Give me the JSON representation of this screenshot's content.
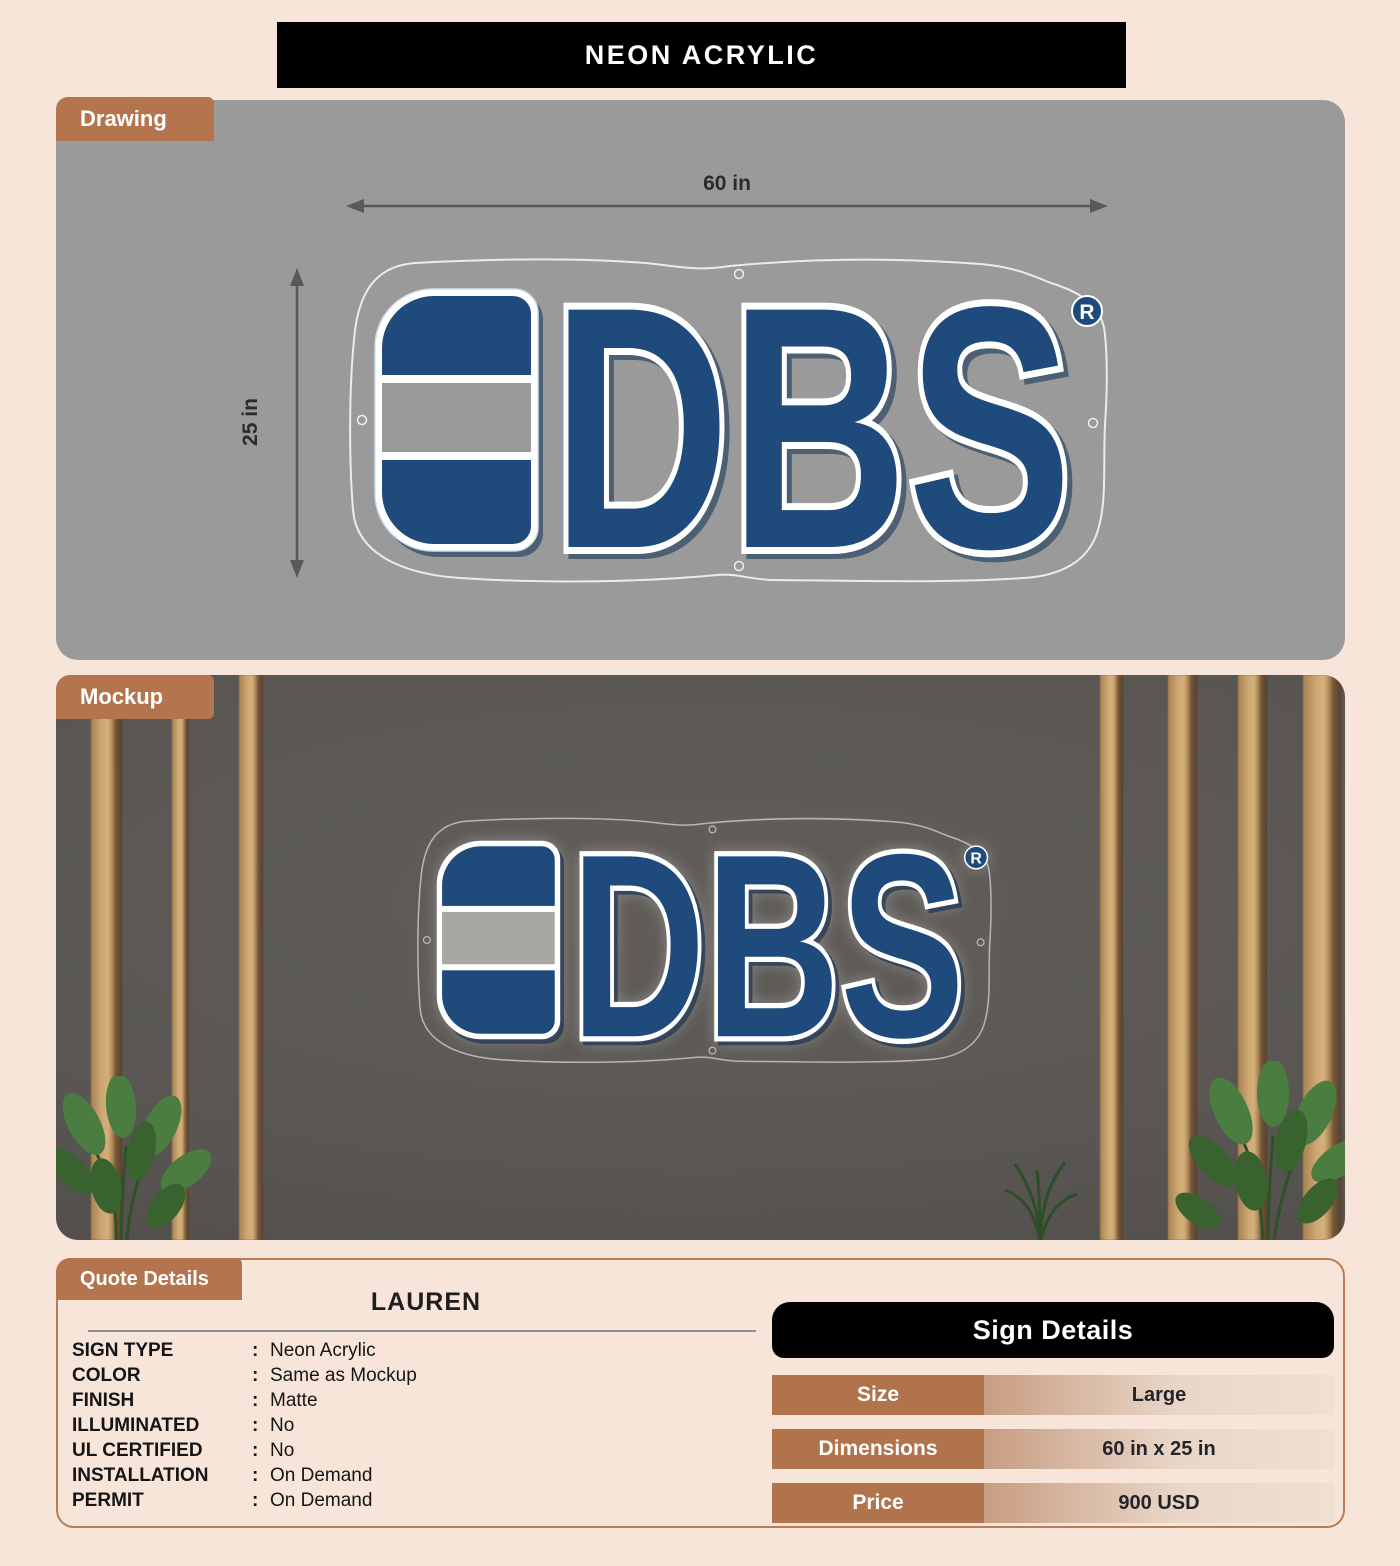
{
  "title": "NEON ACRYLIC",
  "sections": {
    "drawing_label": "Drawing",
    "mockup_label": "Mockup",
    "quote_label": "Quote Details"
  },
  "sign": {
    "brand": "DBS",
    "registered_mark": "R",
    "width_label": "60 in",
    "height_label": "25 in",
    "colors": {
      "blue": "#1e4a7c",
      "band_gray_drawing": "#9a9a9a",
      "band_gray_mockup": "#a9a7a4",
      "outline_white": "#ffffff"
    }
  },
  "quote": {
    "customer_name": "LAUREN",
    "separator": ":",
    "fields": [
      {
        "label": "SIGN TYPE",
        "value": "Neon Acrylic"
      },
      {
        "label": "COLOR",
        "value": "Same as Mockup"
      },
      {
        "label": "FINISH",
        "value": "Matte"
      },
      {
        "label": "ILLUMINATED",
        "value": "No"
      },
      {
        "label": "UL CERTIFIED",
        "value": "No"
      },
      {
        "label": "INSTALLATION",
        "value": "On Demand"
      },
      {
        "label": "PERMIT",
        "value": "On Demand"
      }
    ]
  },
  "sign_details": {
    "header": "Sign Details",
    "rows": [
      {
        "label": "Size",
        "value": "Large"
      },
      {
        "label": "Dimensions",
        "value": "60 in x 25 in"
      },
      {
        "label": "Price",
        "value": "900 USD"
      }
    ]
  }
}
